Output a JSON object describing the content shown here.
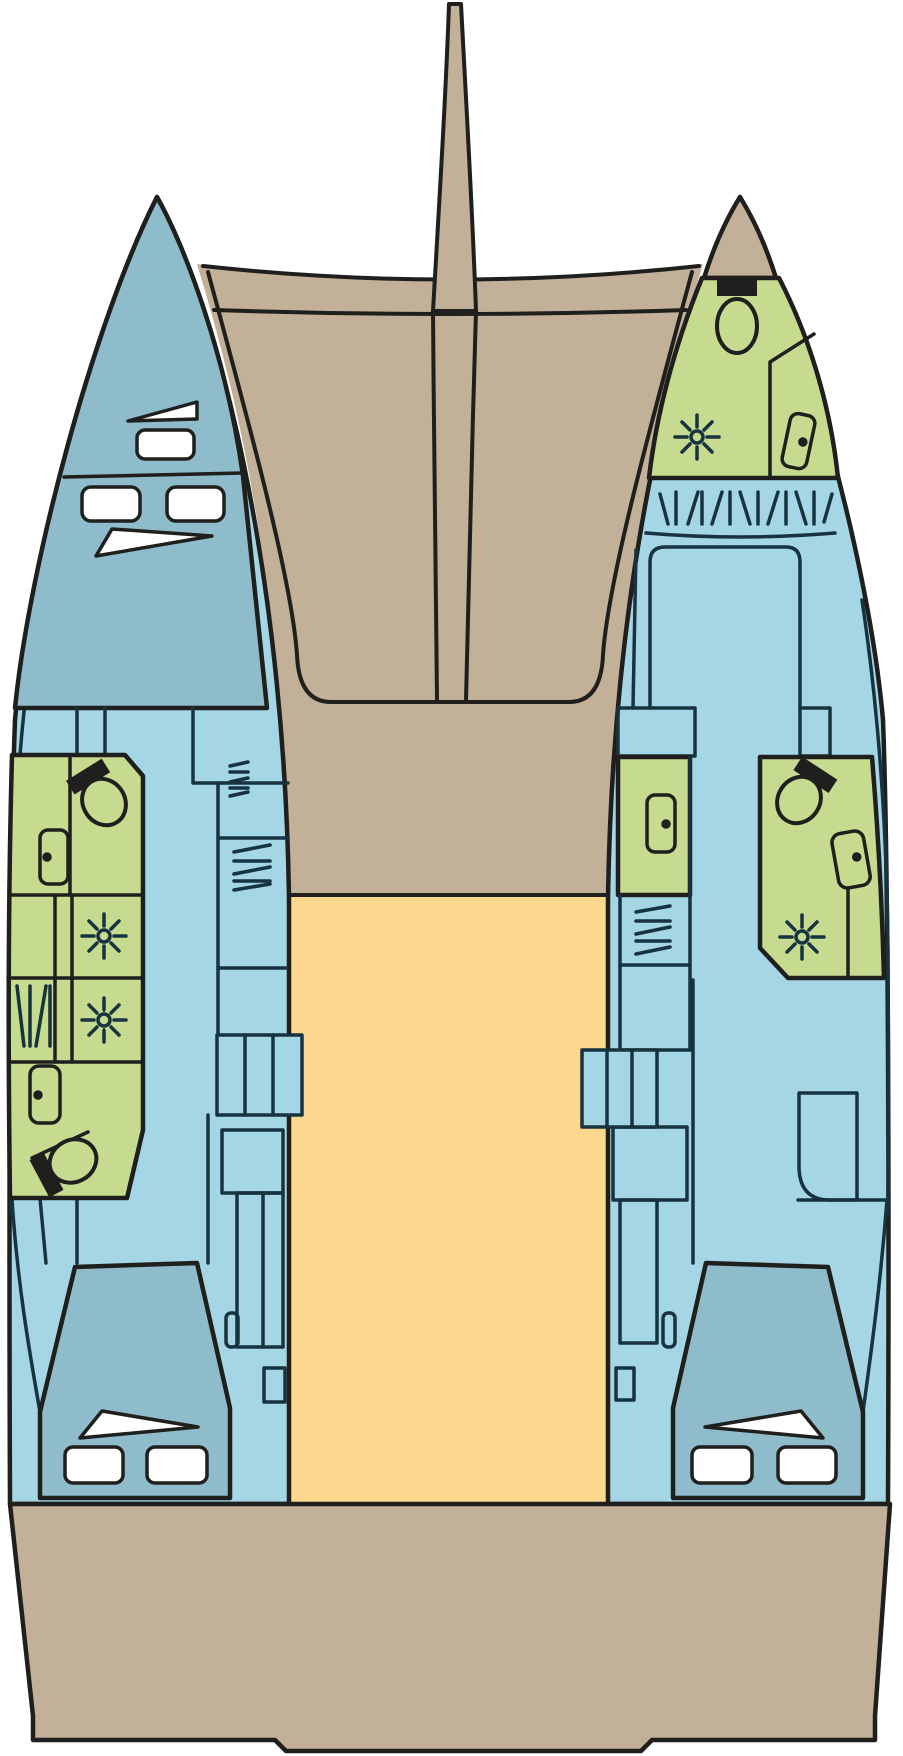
{
  "diagram": {
    "title": "Catamaran deck and accommodation floor plan",
    "type": "boat-floor-plan",
    "view": "top-down",
    "colors": {
      "background": "#ffffff",
      "outline": "#1f1f1d",
      "interior": "#17333f",
      "deck": "#c3b098",
      "hull": "#a5d6e6",
      "berth": "#8fbccb",
      "bathroom": "#c6da90",
      "saloon": "#fbd88d",
      "white": "#ffffff",
      "black": "#1f1f1d"
    },
    "legend": {
      "deck": "Exterior deck / trampoline / stern platform",
      "hull": "Hull interior cabins and corridors",
      "berth": "Berths / sleeping areas",
      "bathroom": "Heads (bathrooms) with shower and toilet",
      "saloon": "Central saloon / cockpit area"
    },
    "regions": [
      "bowsprit",
      "foredeck-crossbeam",
      "trampoline-deck",
      "coachroof",
      "port-bow-cabin",
      "port-bow-hatches",
      "port-forward-head",
      "port-shower-room-forward",
      "port-shower-room-aft",
      "port-aft-head",
      "port-companionway-steps",
      "port-aft-cabin",
      "port-aft-berth",
      "starboard-bow-head",
      "starboard-forward-cabin",
      "starboard-inboard-head",
      "starboard-mid-head",
      "starboard-companionway-steps",
      "starboard-aft-cabin",
      "starboard-aft-berth",
      "saloon-cockpit",
      "stern-platform"
    ],
    "icons": {
      "shower": "shower-star-icon",
      "toilet": "toilet-icon",
      "door": "door-with-handle-icon",
      "hatch": "deck-hatch-icon",
      "grate": "vent-grate-icon",
      "steps": "companionway-steps-icon",
      "pillow": "berth-pillow-icon"
    },
    "counts": {
      "toilets": 4,
      "showers": 4,
      "doors": 5,
      "companionway_steps": 2,
      "aft_berths": 2,
      "bow_hatches": 3
    }
  }
}
